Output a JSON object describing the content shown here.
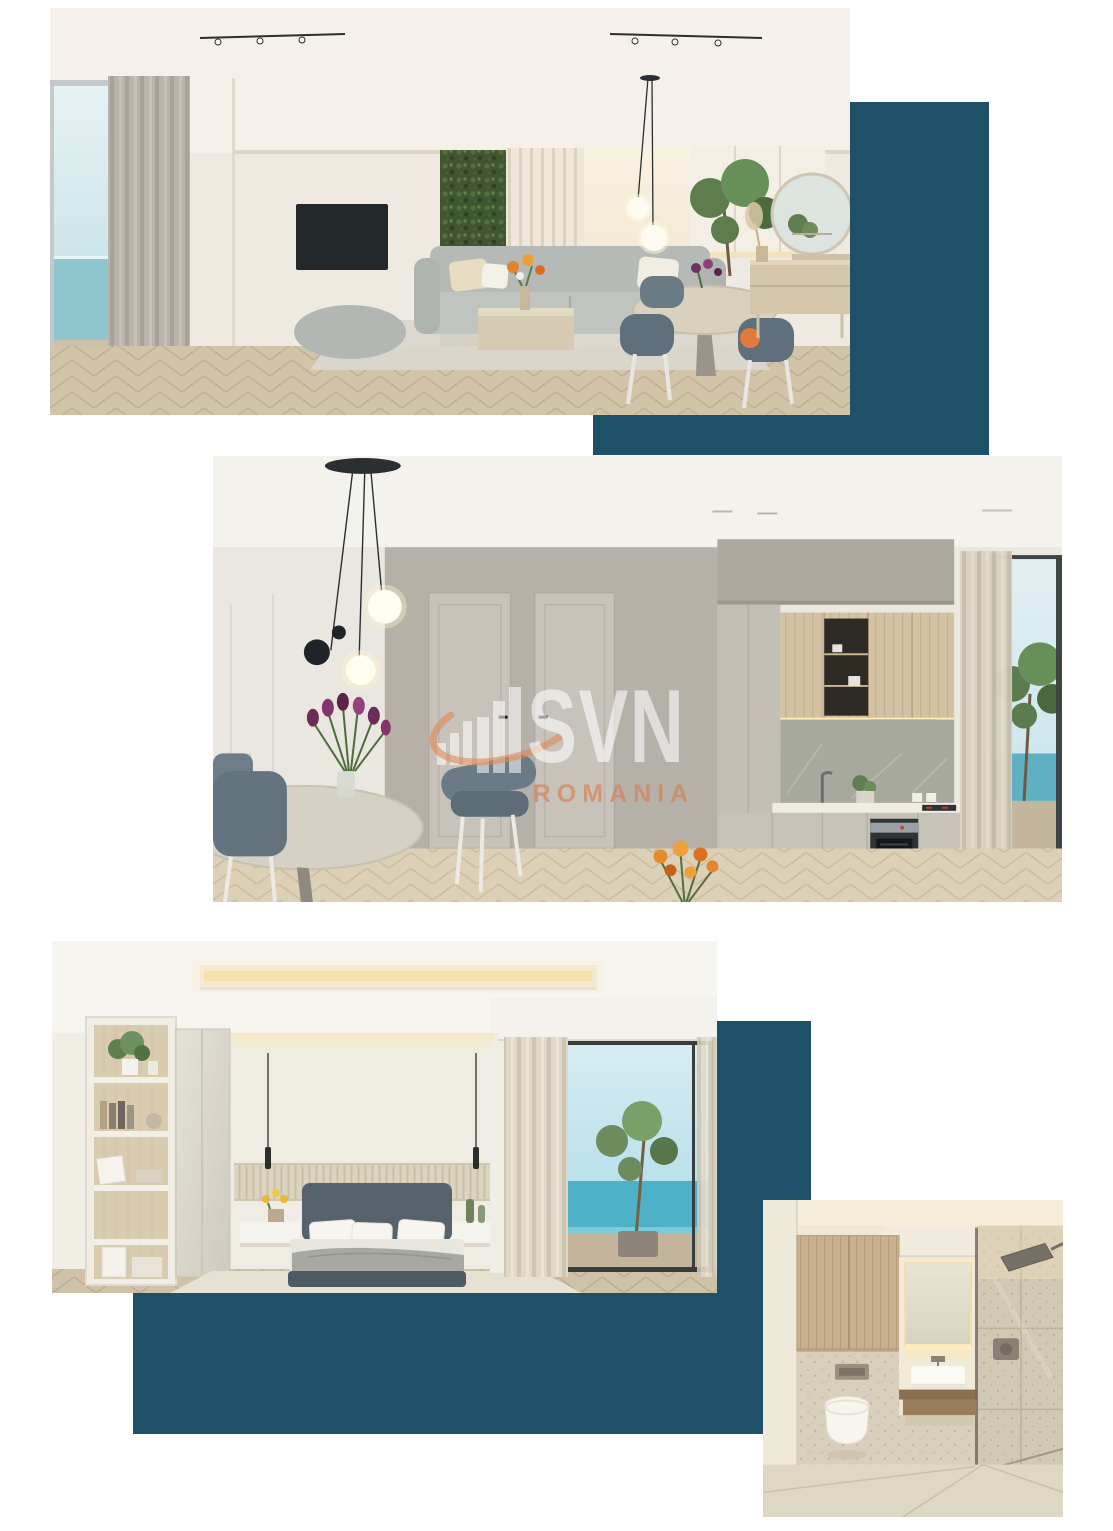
{
  "page": {
    "background": "#ffffff",
    "description": "Real-estate brochure page with four apartment interior renders and dark teal accent rectangles"
  },
  "watermark": {
    "brand": "SVN",
    "country": "ROMANIA"
  },
  "colors": {
    "accent_teal": "#1e5068",
    "watermark_orange": "rgba(217,123,78,0.62)",
    "watermark_white": "rgba(255,255,255,0.58)",
    "sea": "#5fb0c3",
    "floor_wood": "#d2c4a9"
  },
  "icons": {
    "svn_logo_bars": "ascending bar-chart building glyph",
    "svn_logo_swoosh": "orange elliptical orbit swoosh"
  },
  "images": [
    {
      "id": "living-room",
      "alt": "Living room render: grey sofa, green plant wall, slatted panel, wall TV, round dining table with blue chairs, pendant globes, round mirror, sea view window"
    },
    {
      "id": "kitchen",
      "alt": "Kitchen render: grey doors, wood upper cabinets with lit shelf, oven, marble backsplash, dining table with purple tulips, black pendant globes, balcony with sea view"
    },
    {
      "id": "bedroom",
      "alt": "Bedroom render: upholstered bed with white pillows, slatted headboard band, shelving unit with books and plants, cove lighting, balcony with tree and sea view"
    },
    {
      "id": "bathroom",
      "alt": "Bathroom render: wood cabinets, wall-hung toilet, backlit mirror vanity with vessel sink, walk-in shower with glass panel, stone tiles"
    }
  ]
}
